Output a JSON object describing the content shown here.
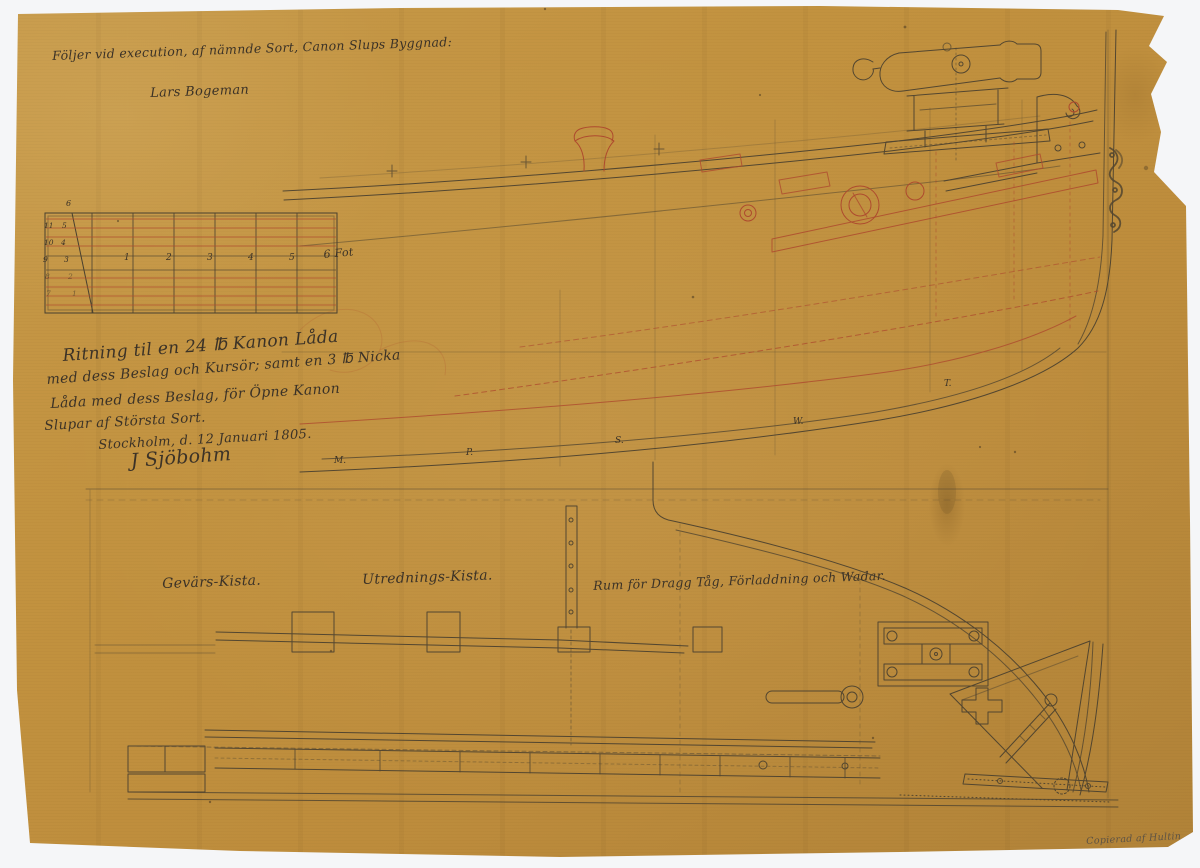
{
  "sheet": {
    "note": {
      "line1": "Följer vid execution, af nämnde Sort, Canon Slups Byggnad:",
      "line2": "Lars Bogeman"
    },
    "title_block": {
      "line1": "Ritning til en 24 ℔ Kanon Låda",
      "line2": "med dess Beslag och Kursör; samt en 3 ℔ Nicka",
      "line3": "Låda med dess Beslag, för Öpne Kanon",
      "line4": "Slupar af Största Sort.",
      "place_date": "Stockholm, d. 12 Januari 1805.",
      "signature": "J Sjöbohm"
    },
    "labels": {
      "gevars_kista": "Gevärs-Kista.",
      "utrednings_kista": "Utrednings-Kista.",
      "rum": "Rum för Dragg Tåg, Förladdning och Wadar."
    },
    "copy_note": "Copierad af Hultin",
    "scale_bar": {
      "unit": "6 Fot",
      "ticks": [
        "1",
        "2",
        "3",
        "4",
        "5"
      ],
      "diag_top": "6",
      "diag_ticks": [
        "5",
        "4",
        "3",
        "2",
        "1"
      ],
      "left_ticks": [
        "11",
        "10",
        "9",
        "8",
        "7"
      ]
    },
    "stations": [
      "M.",
      "P.",
      "S.",
      "W.",
      "T."
    ]
  },
  "colors": {
    "paper": "#c2923f",
    "ink": "#49402f",
    "red_ink": "#ae4a2e",
    "backing": "#f5f6f8"
  }
}
